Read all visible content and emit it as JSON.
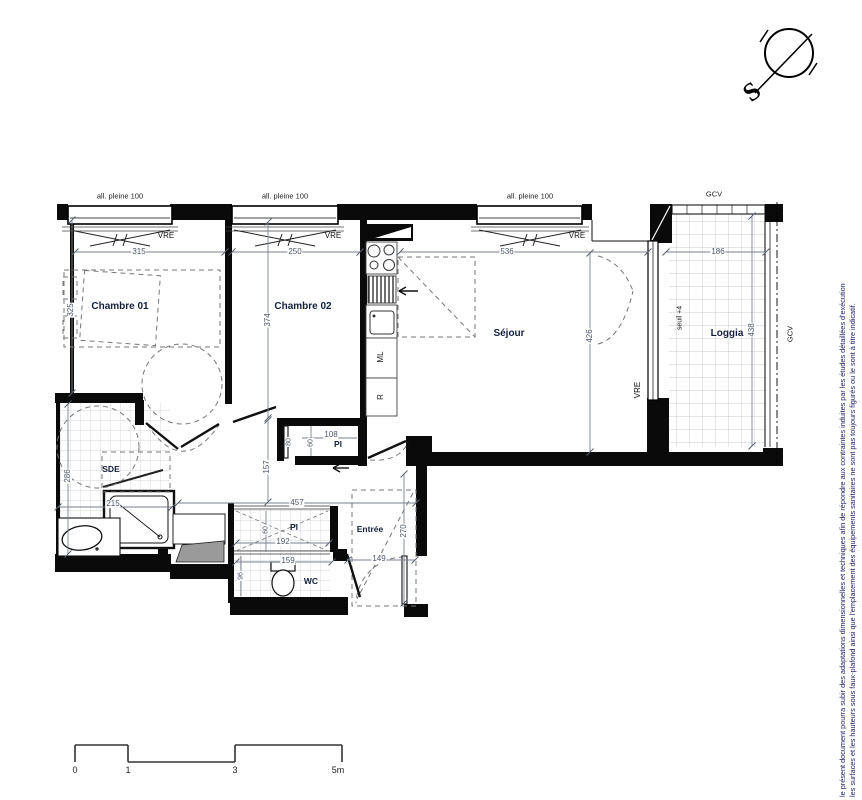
{
  "plan_title": "appartement T2 plan",
  "rooms": {
    "chambre01": "Chambre 01",
    "chambre02": "Chambre 02",
    "sejour": "Séjour",
    "loggia": "Loggia",
    "sde": "SDE",
    "wc": "WC",
    "entree": "Entrée",
    "placard": "Pl"
  },
  "windows": {
    "allege_label": "all. pleine 100",
    "vre_label": "VRE",
    "gcv_label": "GCV",
    "seuil_label": "seuil +4"
  },
  "kitchen": {
    "washing_machine": "ML",
    "fridge": "R"
  },
  "compass": {
    "south": "S"
  },
  "dimensions": {
    "chambre01_width": "315",
    "chambre01_depth": "325",
    "chambre02_width": "250",
    "chambre02_depth": "374",
    "sejour_width": "536",
    "sejour_depth": "426",
    "loggia_width": "186",
    "loggia_depth": "438",
    "sde_depth": "286",
    "sde_width": "215",
    "corridor_width": "457",
    "corridor_depth": "157",
    "placard_width": "108",
    "placard_depth": "60",
    "placard_door": "80",
    "placard_entree_width": "192",
    "placard_entree_depth": "60",
    "wc_width": "159",
    "wc_depth": "96",
    "entree_width": "149",
    "entree_depth": "270"
  },
  "scale_bar": {
    "t0": "0",
    "t1": "1",
    "t3": "3",
    "t5": "5m"
  },
  "disclaimer": {
    "line1": "le présent document pourra subir des adaptations dimensionnelles et techniques afin de répondre aux contraintes induites par les études détaillées d'exécution",
    "line2": "les surfaces et les hauteurs sous faux-plafond ainsi que l'emplacement des équipements sanitaires ne sont pas toujours figurés ou le sont à titre indicatif."
  }
}
